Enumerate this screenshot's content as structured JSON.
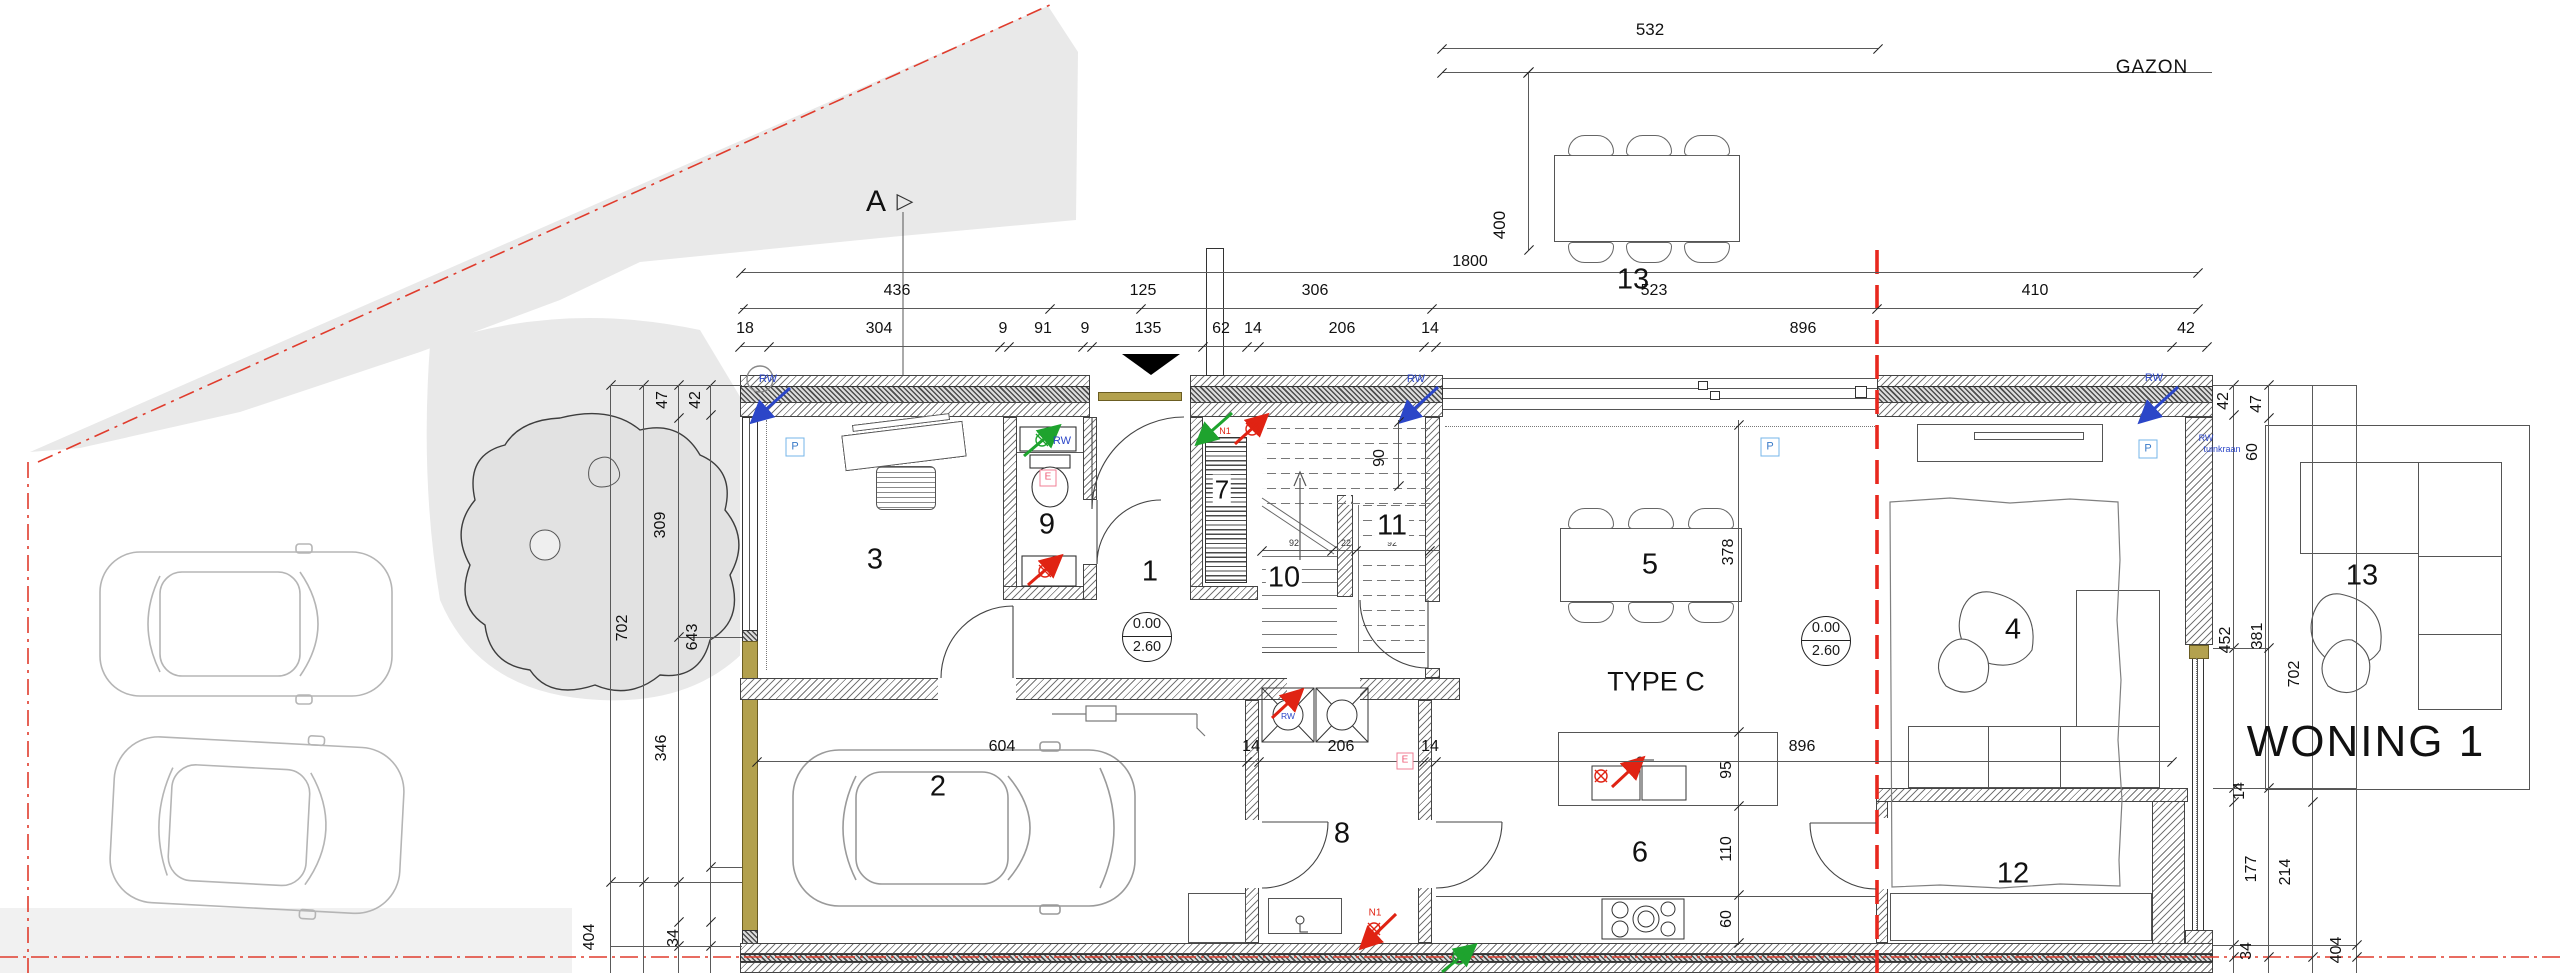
{
  "labels": {
    "gazon": "GAZON",
    "type": "TYPE C",
    "woning": "WONING 1",
    "section": "A",
    "section_glyph": "▷",
    "overall": "1800",
    "terrace_width": "532",
    "terrace_depth": "400",
    "level_floor": "0.00",
    "level_ceiling": "2.60",
    "rw": "RW",
    "tuinkraan": "tuinkraan",
    "p": "P",
    "e": "E",
    "n1": "N1"
  },
  "rooms": {
    "r1": "1",
    "r2": "2",
    "r3": "3",
    "r4": "4",
    "r5": "5",
    "r6": "6",
    "r7": "7",
    "r8": "8",
    "r9": "9",
    "r10": "10",
    "r11": "11",
    "r12": "12",
    "r13": "13"
  },
  "dims": {
    "top_row1": [
      "436",
      "125",
      "306",
      "523",
      "410"
    ],
    "top_row2": [
      "18",
      "304",
      "9",
      "91",
      "9",
      "135",
      "62",
      "14",
      "206",
      "14",
      "896",
      "42"
    ],
    "mid_row": [
      "604",
      "14",
      "206",
      "14",
      "896"
    ],
    "left_col": [
      "47",
      "42",
      "309",
      "702",
      "643",
      "346",
      "404",
      "34"
    ],
    "right_col": [
      "42",
      "47",
      "60",
      "452",
      "381",
      "702",
      "14",
      "177",
      "214",
      "34",
      "404"
    ],
    "kitchen_col": [
      "378",
      "95",
      "110",
      "60"
    ],
    "stair_col": "90",
    "stair_row": [
      "92",
      "22",
      "92"
    ]
  },
  "colors": {
    "boundary_red": "#e03c2d",
    "wood_gold": "#b3a14e",
    "rw_blue": "#2b46c8",
    "supply_green": "#1ea32e",
    "extract_red": "#e02313",
    "p_box_blue": "#74b6e8",
    "e_box_pink": "#f07f96",
    "terrain_gray": "#e8e8e8"
  }
}
